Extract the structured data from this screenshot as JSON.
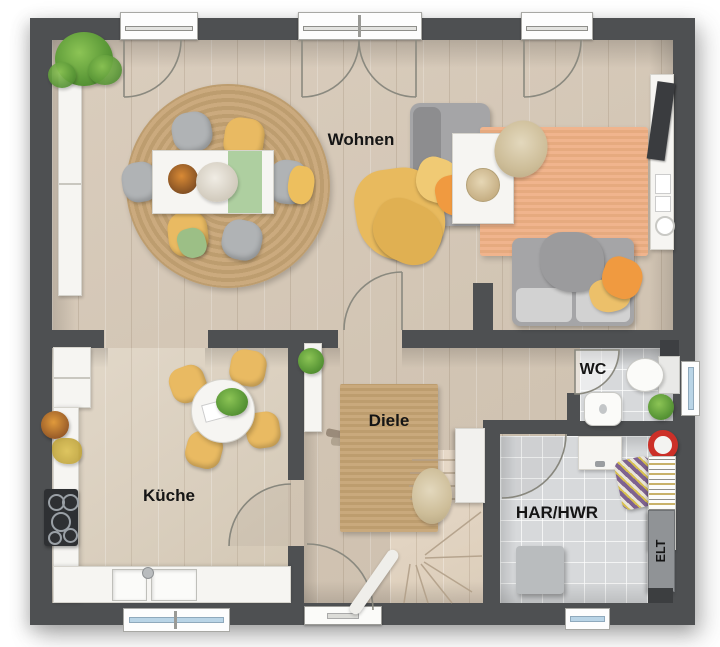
{
  "plan": {
    "labels": {
      "living": "Wohnen",
      "kitchen": "Küche",
      "hall": "Diele",
      "wc": "WC",
      "utility": "HAR/HWR",
      "electrical": "ELT"
    },
    "colors": {
      "wall": "#4e5052",
      "wood_floor": "#d6c9b8",
      "kitchen_floor": "#ded3c3",
      "tile_floor": "#d7d9db",
      "jute_rug": "#c7a577",
      "orange_rug": "#efb28b",
      "sofa_gray": "#a5a5a7",
      "accent_yellow": "#e9ba62",
      "accent_orange": "#f09a40",
      "runner_green": "#aecfa0",
      "plant_green": "#5f9c3a",
      "red_item": "#cc3028",
      "glass_blue": "#b9d4e6"
    }
  }
}
